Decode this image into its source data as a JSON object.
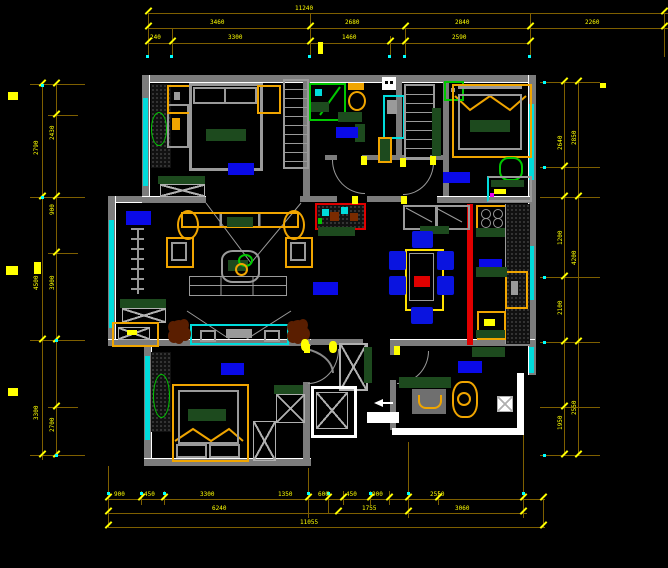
{
  "drawing": {
    "type": "cad-floor-plan",
    "background": "#000000"
  },
  "colors": {
    "wall": "#7c7c7c",
    "wall_inner_face": "#ffffff",
    "window": "#00dcdc",
    "dimension_line": "#7e5f00",
    "dimension_text": "#ffff00",
    "room_label": "#0a0ae8",
    "furniture_accent": "#f0a500",
    "dark_green": "#1d4a1e",
    "bright_green": "#00c800",
    "highlight_wall": "#e00000",
    "plant_brown": "#5a1e00",
    "chair_blue": "#0a14e0"
  },
  "dims": {
    "top": {
      "overall": "11240",
      "mid": [
        "3460",
        "2680",
        "2840",
        "2260"
      ],
      "inner": [
        "240",
        "3300",
        "1460",
        "2590"
      ]
    },
    "bottom": {
      "inner": [
        "900",
        "450",
        "3300",
        "1350",
        "600",
        "450",
        "900",
        "2550"
      ],
      "mid": [
        "6240",
        "1755",
        "3060"
      ],
      "overall": "11055"
    },
    "left": {
      "outer": [
        "2790",
        "4500",
        "3300"
      ],
      "inner": [
        "2430",
        "900",
        "3900",
        "2700"
      ]
    },
    "right": {
      "outer": [
        "2850",
        "4200",
        "2550"
      ],
      "inner": [
        "2640",
        "1200",
        "2100",
        "1950"
      ]
    }
  }
}
